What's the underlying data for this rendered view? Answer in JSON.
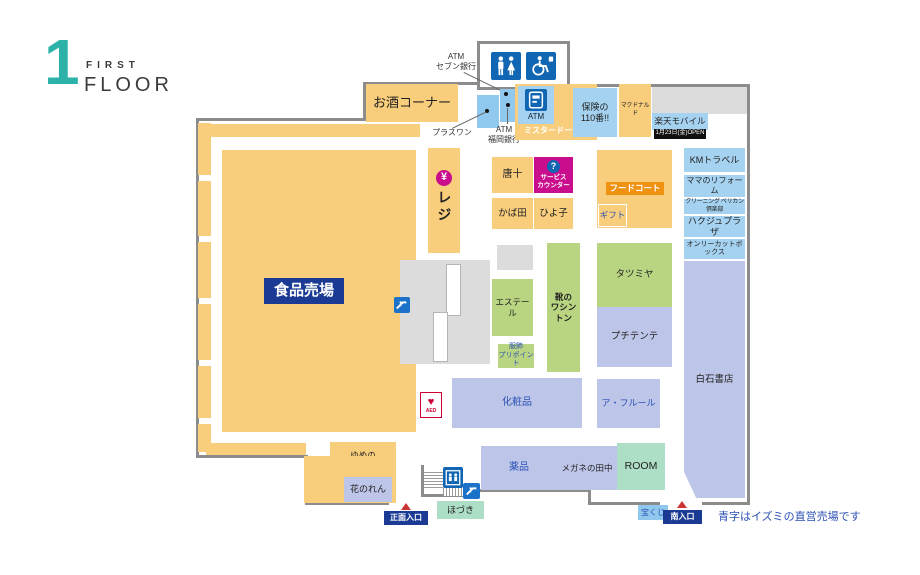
{
  "logo": {
    "number": "1",
    "line1": "FIRST",
    "line2": "FLOOR"
  },
  "legend": "青字はイズミの直営売場です",
  "entrances": {
    "main": "正面入口",
    "south": "南入口"
  },
  "annotations": {
    "atm_seven": "ATM\nセブン銀行",
    "plus_one": "プラスワン",
    "atm_fukuoka": "ATM\n福岡銀行",
    "atm_label": "ATM",
    "open_badge": "1月23日(金)OPEN",
    "aed": "AED",
    "register": "レジ",
    "yen": "¥",
    "question": "?"
  },
  "shops": {
    "food_hall": "食品売場",
    "sake_corner": "お酒コーナー",
    "mister_donut": "ミスタードーナツ",
    "hoken110": "保険の\n110番!!",
    "mcdonalds": "マクドナルド",
    "rakuten_mobile": "楽天モバイル",
    "km_travel": "KMトラベル",
    "mama_reform": "ママのリフォーム",
    "pelican_cleaning": "クリーニング ペリカン倶楽部",
    "hakuju_plaza": "ハクジュプラザ",
    "only_cut_box": "オンリーカットボックス",
    "karaju": "唐十",
    "service_counter": "サービス\nカウンター",
    "kabata": "かば田",
    "hiyoko": "ひよ子",
    "food_court": "フードコート",
    "gift": "ギフト",
    "estelle": "エステール",
    "washington": "靴の\nワシントン",
    "tatsumiya": "タツミヤ",
    "petit_tente": "プチテンテ",
    "fukushoku_pripoint": "服飾\nプリポイント",
    "shiraishi_books": "白石書店",
    "cosmetics": "化粧品",
    "a_fleur": "ア・フルール",
    "drugs": "薬品",
    "megane_tanaka": "メガネの田中",
    "room": "ROOM",
    "yume_bakery": "ゆめの\nパン屋さん",
    "hananoren": "花のれん",
    "hozuki": "ほづき",
    "takarakuji": "宝くじ"
  },
  "colors": {
    "orange": "#f8cd7c",
    "blue": "#a5d2f0",
    "green": "#bad581",
    "lavender": "#bdc6e8",
    "mint": "#addec6",
    "magenta": "#c90d8c",
    "navy": "#1a3a94",
    "icon_blue": "#1166b4",
    "wall_gray": "#8c8c8c",
    "text_blue": "#2b50b5",
    "badge_orange": "#ef9212",
    "logo_teal": "#2cb2a8",
    "entrance_red": "#cc3333"
  }
}
